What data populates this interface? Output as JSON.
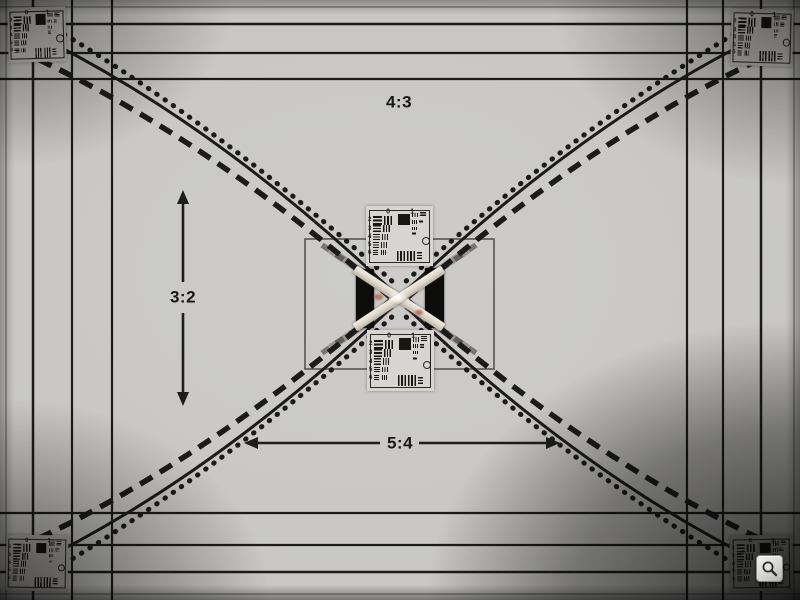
{
  "photo": {
    "labels": {
      "top": "4:3",
      "left": "3:2",
      "bottom": "5:4"
    },
    "usaf_target": {
      "top_labels": [
        "0",
        "1"
      ],
      "left_labels": [
        "2",
        "3",
        "4",
        "5",
        "6"
      ]
    },
    "colors": {
      "background": "#c8c7c5",
      "line": "#1b1b1a",
      "label_text": "#171716",
      "target_bg": "#d7d5d1",
      "target_ink": "#17160f",
      "black_bar": "#0c0c0a",
      "tape_light": "#f3eee5",
      "tape_dark": "#b9b1a2"
    }
  },
  "controls": {
    "zoom_button": {
      "icon": "magnifier-icon"
    }
  }
}
